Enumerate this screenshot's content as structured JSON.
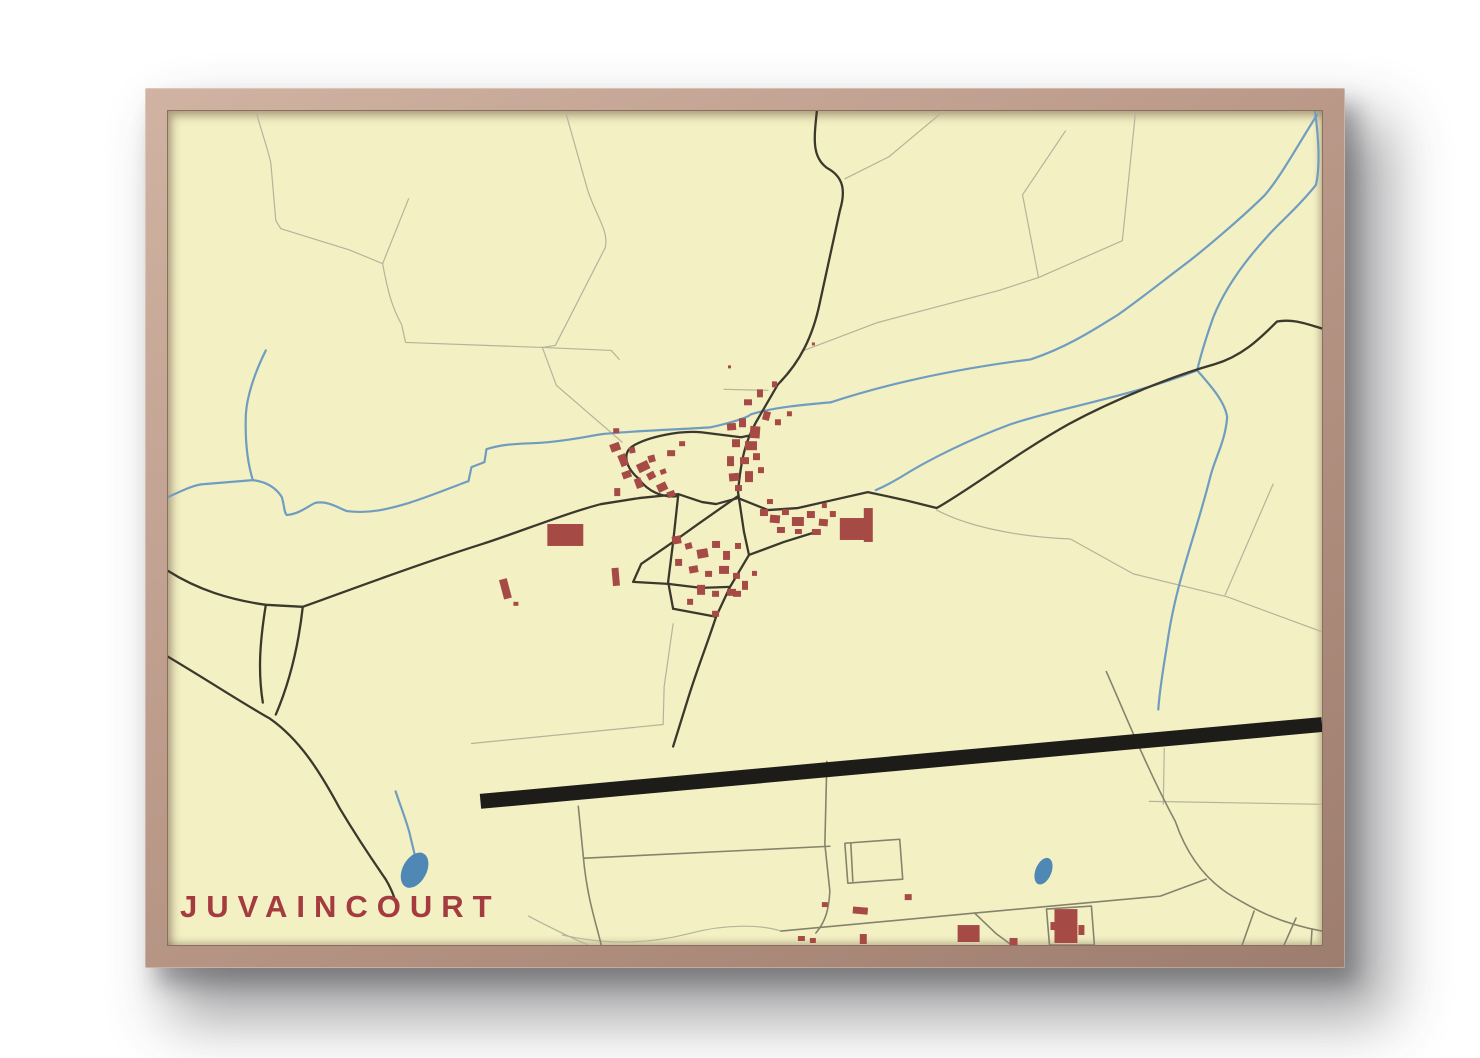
{
  "poster": {
    "title": "JUVAINCOURT"
  },
  "colors": {
    "page_background": "#ffffff",
    "frame_wood_light": "#d0b3a2",
    "frame_wood_dark": "#9d7d6e",
    "paper": "#f3f0c4",
    "title": "#a43b3f",
    "building": "#a64a46",
    "road_main": "#3b382c",
    "road_medium": "#86836c",
    "road_minor": "#b6b399",
    "stream": "#6f9dc0",
    "pond": "#4f87b5",
    "runway": "#1d1c19"
  },
  "map": {
    "viewbox": "0 0 1156 836",
    "field_lines": [
      "M88,0 C96,28 101,42 103,52 L108,110 L113,118 L181,139 L215,153",
      "M215,153 L241,88",
      "M215,153 C220,180 224,196 234,214 L238,232 L375,237",
      "M398,0 L420,78 C428,104 442,120 438,137 L388,235 L375,237",
      "M375,237 L444,240 L452,249",
      "M375,237 L389,275 L455,332",
      "M899,20 L856,84 L872,167 L956,130 L969,3",
      "M872,167 L832,180 L711,212 L637,240",
      "M770,400 C800,416 850,427 904,429 L967,464 L1061,487 L1156,522",
      "M1107,374 L1059,485",
      "M777,0 L722,46 L678,68",
      "M557,279 L601,280",
      "M506,514 L497,577 L496,615 L304,634",
      "M983,692 L1156,695",
      "M998,639 L997,695",
      "M361,807 C382,818 402,828 421,836",
      "M395,826 C440,836 480,835 520,825 C560,814 596,816 614,822"
    ],
    "medium_roads": [
      "M411,697 L417,757 C421,792 429,815 434,836",
      "M660,652 L658,735 L663,782 C662,800 659,812 649,824",
      "M417,749 L663,737",
      "M678,734 L733,730 L736,770 L681,774 Z",
      "M684,734 L686,772",
      "M614,822 L808,804 L994,787 L1040,770",
      "M940,562 C962,612 982,662 1009,712 C1021,747 1041,772 1066,787 C1086,799 1112,814 1156,822",
      "M1088,802 L1076,836",
      "M1130,809 L1118,836",
      "M1146,820 L1145,836",
      "M880,800 L925,797 L928,836 L883,836 Z",
      "M808,804 L830,825 L845,836"
    ],
    "streams": [
      "M98,240 C86,264 79,287 78,304 C77,332 80,354 85,370",
      "M0,387 C15,380 28,374 36,374 L85,370 C101,372 109,379 114,387 C117,397 116,402 119,405 C131,404 139,397 147,393 C159,390 171,398 179,401 C201,404 221,399 241,393 C266,385 287,376 301,371 L304,357 L317,352 L319,339 C341,332 361,334 381,332 C411,329 426,325 434,324 C471,320 521,319 544,317 C566,312 581,307 584,304 C606,297 641,294 664,292",
      "M664,292 C731,270 801,257 864,249 C901,237 931,217 952,204 C976,187 1001,167 1017,155 C1041,137 1081,102 1099,84 C1116,64 1136,27 1151,4",
      "M1149,0 C1153,30 1154,56 1150,74 C1131,98 1113,112 1101,126 C1079,150 1059,177 1047,207 C1041,224 1035,242 1031,260",
      "M1031,260 C961,287 896,297 844,314 C801,330 761,350 734,367 C724,373 716,377 709,380",
      "M1031,260 C1046,277 1059,292 1061,307 C1059,332 1049,347 1044,367 C1029,427 1009,474 1001,534 C996,564 993,584 992,600",
      "M228,682 C233,697 239,712 242,724 C245,737 247,744 248,750"
    ],
    "main_roads": [
      "M650,0 C647,28 645,46 660,57 C677,66 679,80 673,100 L653,192 C646,226 633,252 611,274 L589,312 C579,330 574,348 571,382 L577,422 L582,445 L563,477 L549,507 C541,532 529,562 520,592 L506,637",
      "M434,394 L472,388 L511,384 L535,392 L549,394 L571,388 L601,400 L631,398 L666,390 L701,382 L738,390 L770,398 C802,380 852,342 902,314 C952,287 1012,264 1048,254 C1075,246 1092,230 1111,211 C1128,208 1142,214 1156,218",
      "M0,461 C30,480 62,490 98,495 L135,497 C172,484 242,457 315,434 C352,422 402,402 434,394",
      "M0,547 C42,572 72,592 102,609 C132,630 152,662 172,699 C187,724 202,747 218,770 C224,780 227,788 229,797",
      "M135,497 C130,542 120,577 108,605",
      "M98,495 C92,532 90,562 95,593",
      "M589,324 L574,327 L534,322 C511,320 481,327 467,335 C451,344 463,362 471,368 C481,382 496,388 511,386",
      "M571,386 L531,414 L506,432 L474,454 L466,472",
      "M582,445 L617,432 L649,422",
      "M511,386 L506,432 L501,472 L506,499",
      "M466,472 L501,474 L534,478 L563,477",
      "M506,499 L549,507"
    ],
    "runway": {
      "d": "M313,692 L1156,615",
      "width": 15
    },
    "ponds": [
      {
        "cx": 247,
        "cy": 761,
        "rx": 12,
        "ry": 19,
        "rot": 28
      },
      {
        "cx": 877,
        "cy": 762,
        "rx": 8,
        "ry": 14,
        "rot": 22
      }
    ],
    "buildings": [
      [
        443,
        333,
        10,
        8,
        -20
      ],
      [
        452,
        344,
        8,
        12,
        -22
      ],
      [
        462,
        337,
        6,
        6,
        -10
      ],
      [
        470,
        352,
        12,
        9,
        -25
      ],
      [
        481,
        345,
        7,
        7,
        -15
      ],
      [
        455,
        361,
        9,
        7,
        -20
      ],
      [
        468,
        368,
        7,
        10,
        -20
      ],
      [
        480,
        362,
        8,
        7,
        -28
      ],
      [
        490,
        373,
        10,
        8,
        -25
      ],
      [
        500,
        381,
        8,
        6,
        -20
      ],
      [
        447,
        378,
        6,
        8,
        0
      ],
      [
        493,
        359,
        6,
        5,
        -20
      ],
      [
        500,
        340,
        8,
        6,
        0
      ],
      [
        512,
        331,
        6,
        5,
        0
      ],
      [
        446,
        318,
        6,
        5,
        0
      ],
      [
        560,
        313,
        9,
        7,
        -5
      ],
      [
        572,
        308,
        7,
        9,
        0
      ],
      [
        583,
        316,
        10,
        12,
        4
      ],
      [
        565,
        329,
        8,
        8,
        0
      ],
      [
        578,
        331,
        12,
        9,
        0
      ],
      [
        560,
        346,
        7,
        10,
        0
      ],
      [
        573,
        347,
        9,
        7,
        0
      ],
      [
        586,
        343,
        7,
        7,
        0
      ],
      [
        562,
        363,
        10,
        8,
        -5
      ],
      [
        578,
        361,
        8,
        11,
        0
      ],
      [
        591,
        357,
        6,
        6,
        0
      ],
      [
        568,
        375,
        7,
        6,
        0
      ],
      [
        596,
        301,
        7,
        9,
        15
      ],
      [
        608,
        309,
        6,
        6,
        0
      ],
      [
        620,
        301,
        5,
        5,
        0
      ],
      [
        577,
        289,
        8,
        6,
        0
      ],
      [
        590,
        279,
        6,
        8,
        0
      ],
      [
        605,
        271,
        5,
        6,
        0
      ],
      [
        593,
        399,
        8,
        7,
        0
      ],
      [
        603,
        405,
        10,
        8,
        5
      ],
      [
        615,
        399,
        7,
        6,
        0
      ],
      [
        625,
        407,
        12,
        9,
        0
      ],
      [
        640,
        401,
        8,
        7,
        0
      ],
      [
        652,
        409,
        9,
        7,
        5
      ],
      [
        663,
        401,
        6,
        6,
        0
      ],
      [
        610,
        417,
        8,
        6,
        0
      ],
      [
        628,
        419,
        7,
        5,
        0
      ],
      [
        645,
        419,
        9,
        6,
        0
      ],
      [
        600,
        389,
        6,
        5,
        0
      ],
      [
        655,
        393,
        5,
        5,
        0
      ],
      [
        673,
        408,
        26,
        22,
        0
      ],
      [
        697,
        398,
        9,
        34,
        0
      ],
      [
        505,
        426,
        9,
        8,
        -10
      ],
      [
        518,
        433,
        7,
        6,
        -15
      ],
      [
        530,
        439,
        11,
        9,
        -10
      ],
      [
        545,
        431,
        8,
        7,
        0
      ],
      [
        556,
        441,
        7,
        9,
        0
      ],
      [
        568,
        433,
        6,
        6,
        0
      ],
      [
        508,
        449,
        7,
        7,
        0
      ],
      [
        522,
        456,
        9,
        7,
        -10
      ],
      [
        538,
        461,
        7,
        6,
        0
      ],
      [
        552,
        456,
        10,
        8,
        0
      ],
      [
        566,
        463,
        7,
        6,
        0
      ],
      [
        530,
        475,
        8,
        10,
        0
      ],
      [
        545,
        481,
        7,
        6,
        0
      ],
      [
        560,
        479,
        9,
        7,
        0
      ],
      [
        520,
        489,
        6,
        6,
        0
      ],
      [
        575,
        471,
        6,
        9,
        0
      ],
      [
        585,
        461,
        5,
        5,
        0
      ],
      [
        545,
        501,
        7,
        6,
        0
      ],
      [
        334,
        469,
        8,
        20,
        -15
      ],
      [
        346,
        492,
        5,
        4,
        0
      ],
      [
        445,
        458,
        7,
        18,
        -5
      ],
      [
        566,
        481,
        8,
        6,
        0
      ],
      [
        380,
        414,
        36,
        22,
        0
      ],
      [
        561,
        255,
        3,
        3,
        0
      ],
      [
        645,
        232,
        3,
        3,
        0
      ],
      [
        738,
        785,
        7,
        6,
        0
      ],
      [
        655,
        793,
        6,
        5,
        0
      ],
      [
        631,
        827,
        7,
        5,
        0
      ],
      [
        643,
        829,
        6,
        5,
        0
      ],
      [
        686,
        798,
        15,
        7,
        5
      ],
      [
        693,
        825,
        7,
        10,
        0
      ],
      [
        791,
        816,
        22,
        17,
        0
      ],
      [
        843,
        829,
        8,
        7,
        0
      ],
      [
        888,
        800,
        23,
        34,
        0
      ],
      [
        884,
        813,
        5,
        8,
        0
      ],
      [
        912,
        816,
        6,
        10,
        0
      ]
    ]
  }
}
